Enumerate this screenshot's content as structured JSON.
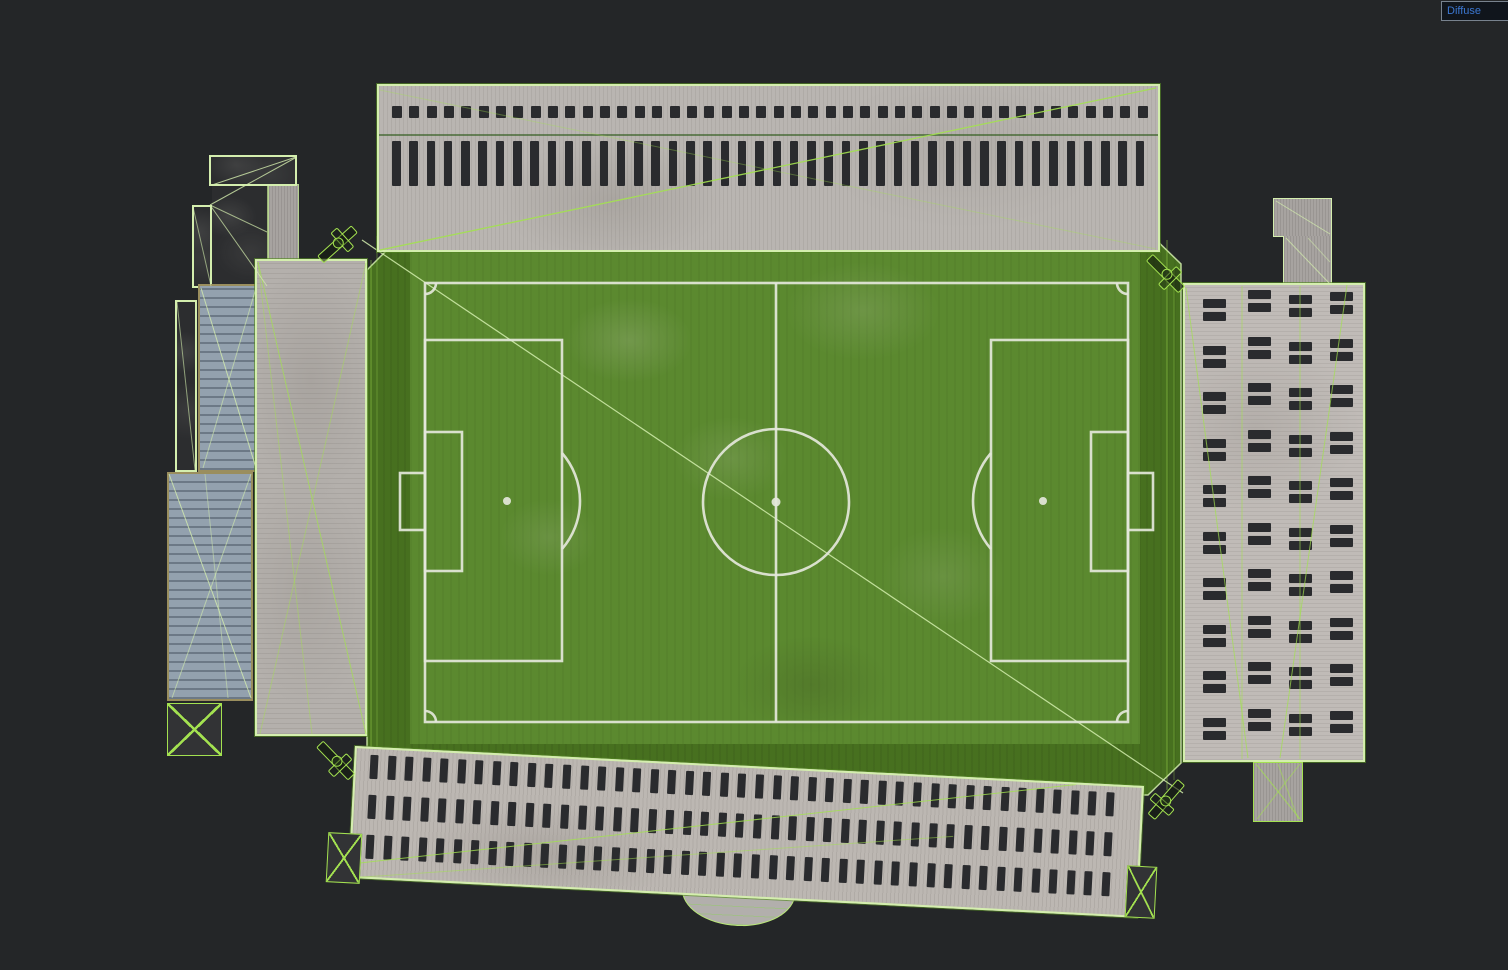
{
  "viewport": {
    "shading_label": "Diffuse"
  },
  "colors": {
    "background": "#242628",
    "wireframe": "#a3e150",
    "wireframe_pale": "#d4eeae",
    "pitch_line": "#e4e7db",
    "window_dark": "#2a2b2e",
    "concrete": "#b9b5b1",
    "grass_apron": "#47701f",
    "grass_pitch": "#5b892f",
    "blue_roof": "#93a1ae",
    "tan_border": "#9a8e5e",
    "roof_dark": "#2c2d2f",
    "label_text": "#3b76d0",
    "label_bg": "#10151c",
    "label_border": "#78828e"
  },
  "scene": {
    "north_stand": {
      "name": "north-grandstand",
      "vent_count": 44,
      "window_count": 44
    },
    "south_stand": {
      "name": "south-grandstand",
      "window_rows": 3,
      "windows_per_row": 43
    },
    "east_stand": {
      "name": "east-grandstand",
      "window_columns": 4,
      "window_rows": 10
    },
    "west_stand": {
      "name": "west-grandstand"
    },
    "pitch": {
      "name": "football-pitch"
    },
    "floodlight_count": 4
  }
}
